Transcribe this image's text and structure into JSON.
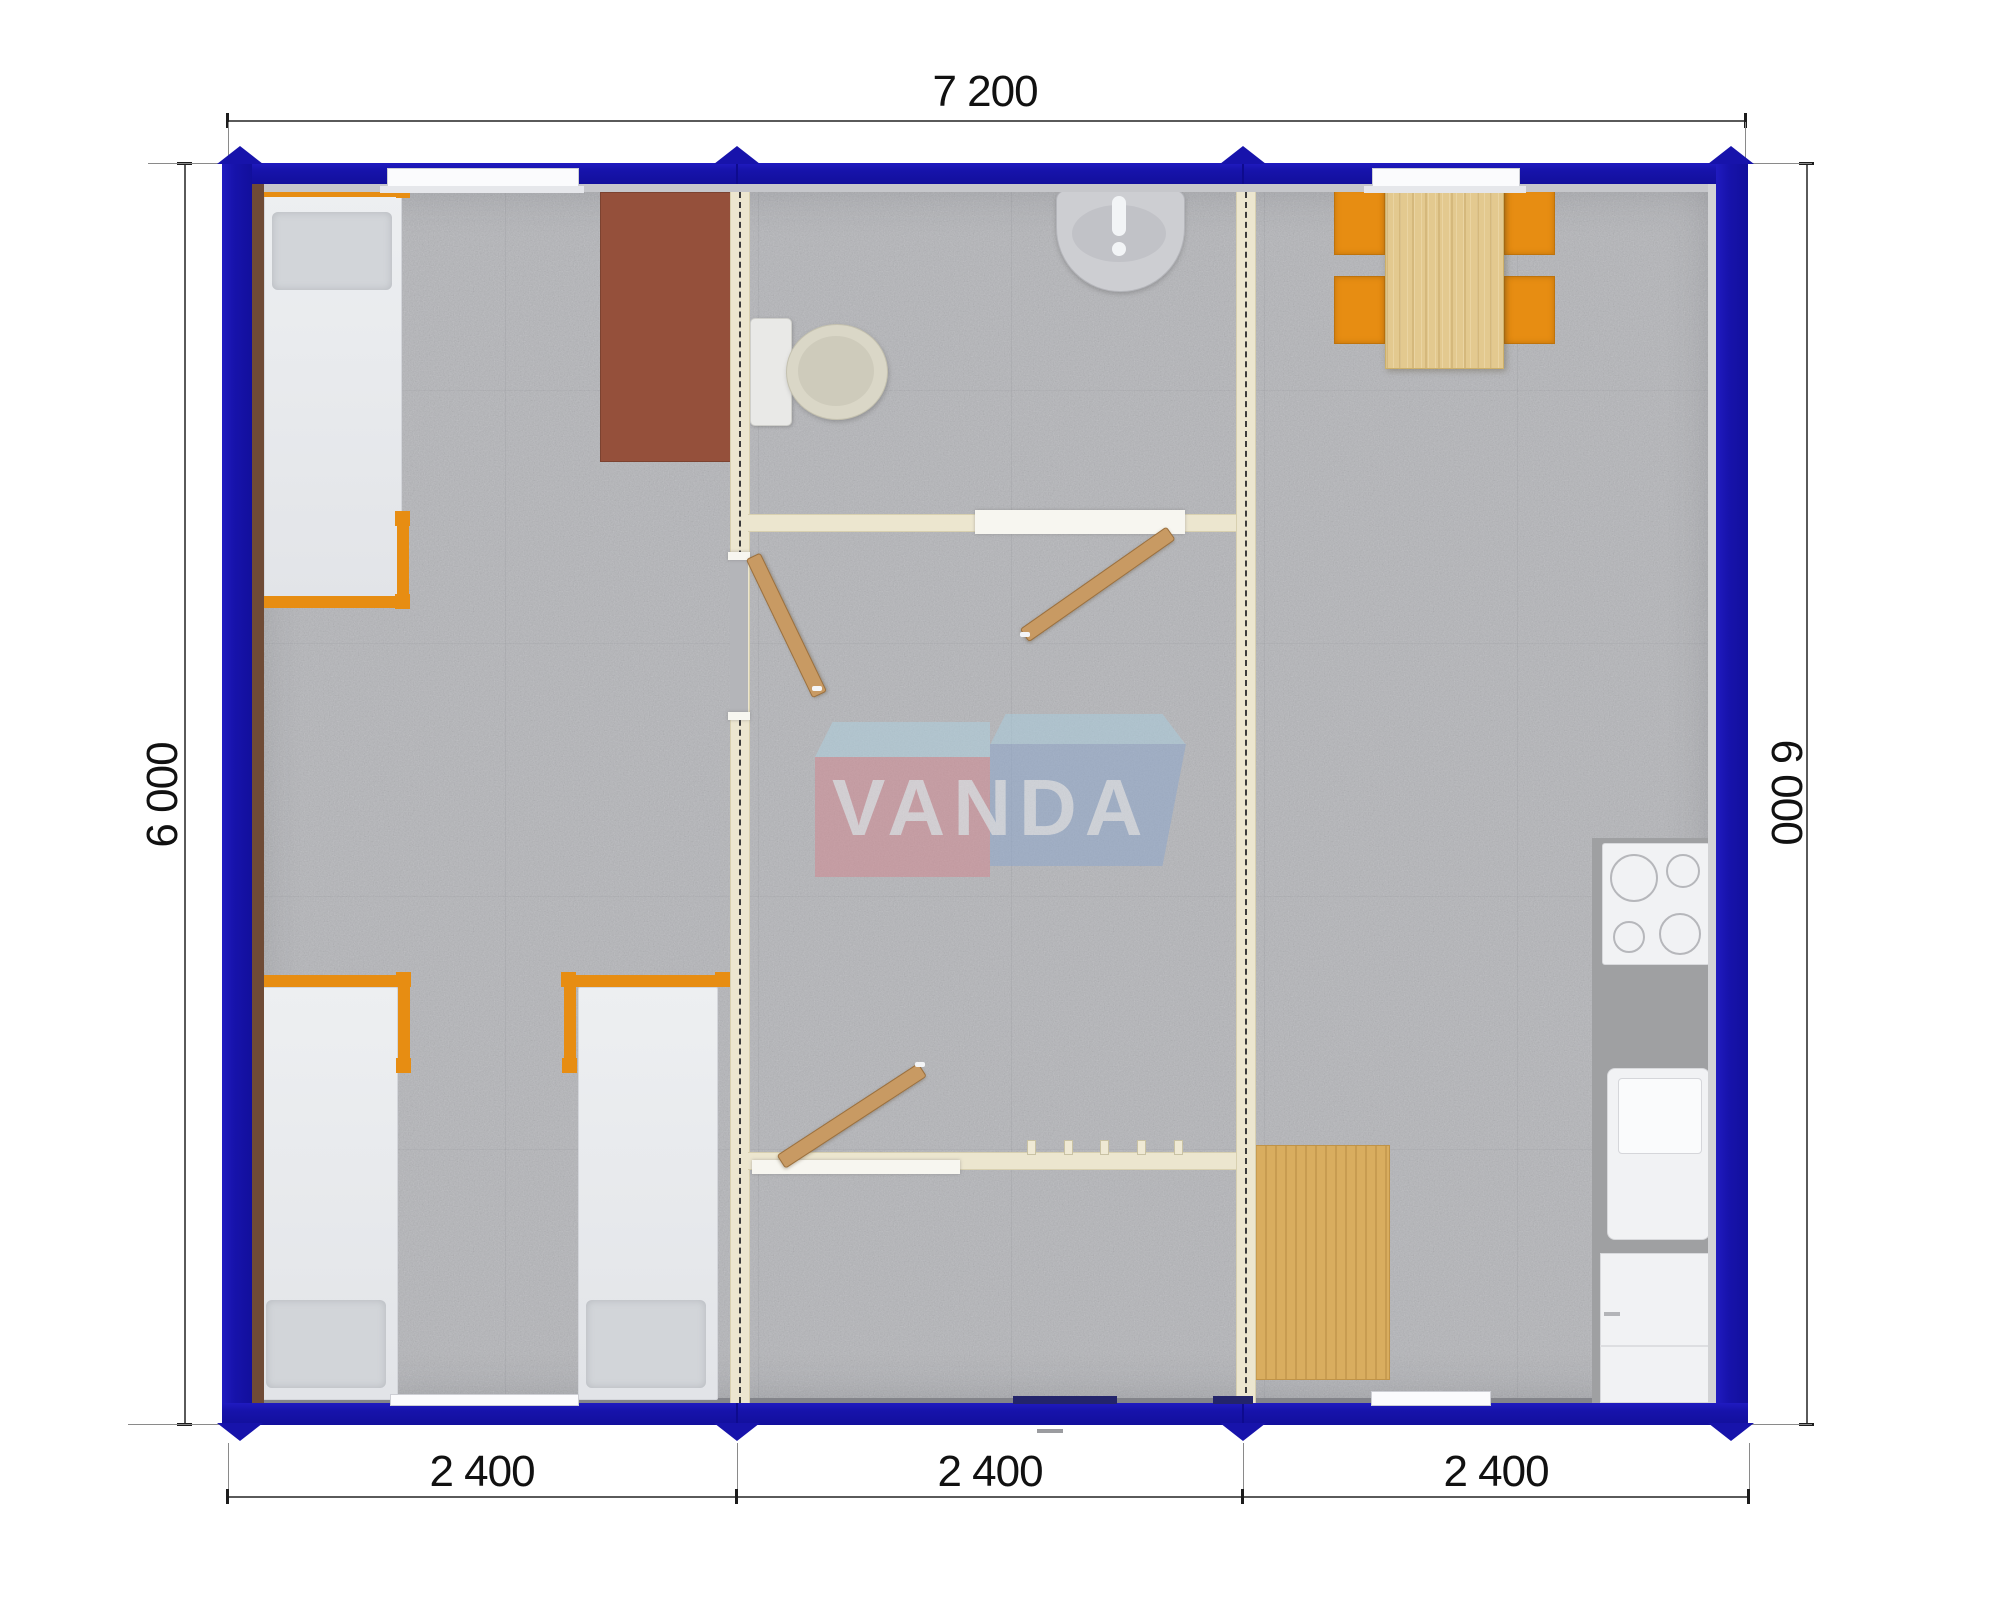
{
  "drawing": {
    "type": "floor-plan",
    "watermark_text": "VANDA"
  },
  "dimensions": {
    "top_width_label": "7 200",
    "left_height_label": "6 000",
    "right_height_label": "6 000",
    "bottom_segment_labels": [
      "2 400",
      "2 400",
      "2 400"
    ]
  },
  "palette": {
    "wall_blue": "#1713ab",
    "partition_cream": "#ece6cf",
    "carpet_gray": "#b4b5b9",
    "furniture_orange": "#e78d12",
    "wood_light": "#e3c98f",
    "wood_door": "#c89a63",
    "cabinet_brown": "#95503b",
    "fixture_white": "#f1f2f4",
    "counter_gray": "#9fa0a2",
    "watermark_pink": "#d4858e",
    "watermark_blue": "#8ba6cd",
    "watermark_lightblue": "#aed2e2"
  },
  "modules": {
    "left": {
      "furniture": [
        "single-bed",
        "single-bed",
        "single-bed",
        "brown-wardrobe"
      ]
    },
    "middle": {
      "furniture": [
        "toilet",
        "washbasin",
        "door-leaf",
        "door-leaf",
        "door-leaf",
        "coat-hooks"
      ]
    },
    "right": {
      "furniture": [
        "dining-table",
        "chair",
        "chair",
        "chair",
        "chair",
        "cooktop",
        "kitchen-sink",
        "kitchen-cabinet",
        "wood-floor-mat"
      ]
    }
  }
}
